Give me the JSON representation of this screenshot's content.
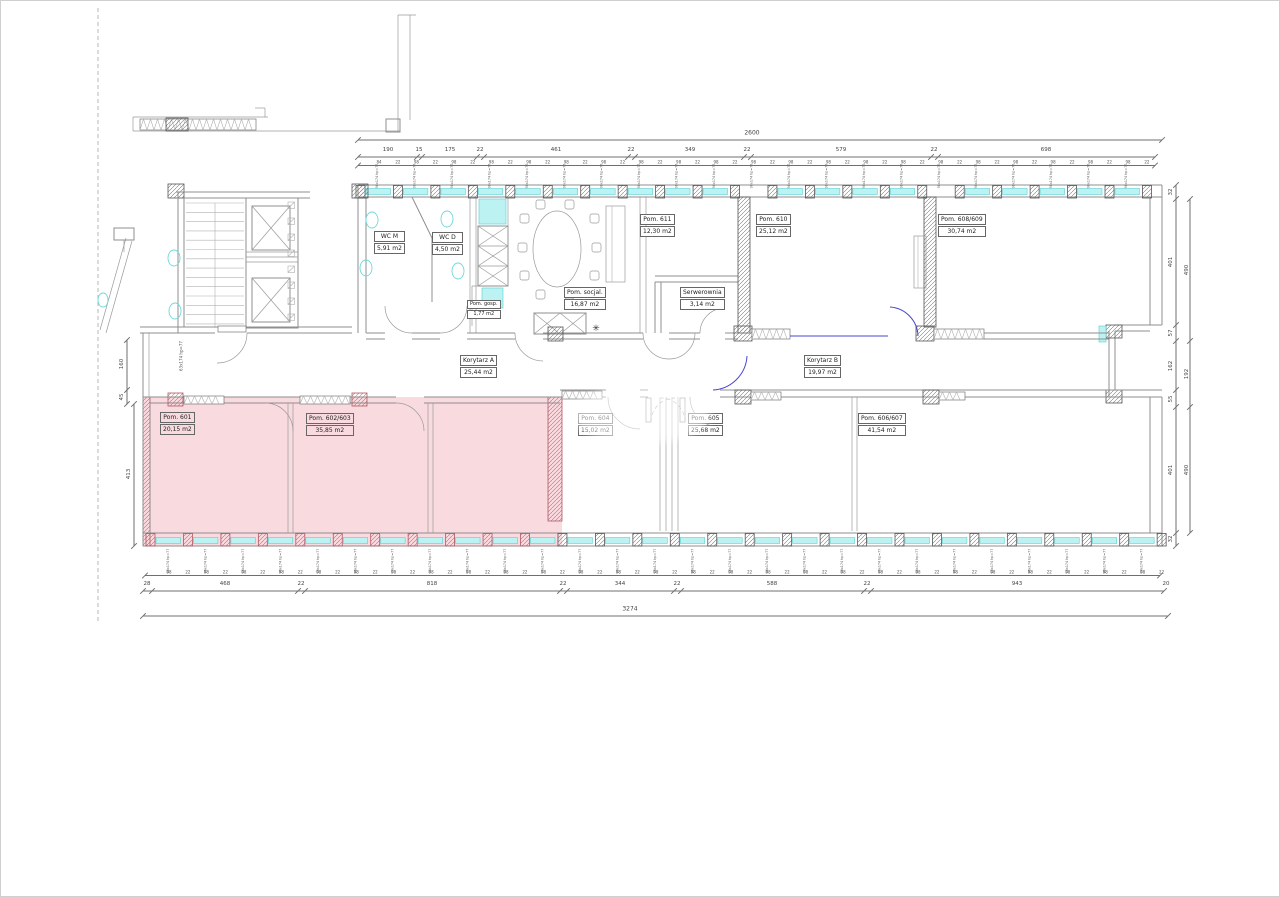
{
  "plan": {
    "rooms": {
      "wc_m": {
        "name": "WC M",
        "area": "5,91 m2"
      },
      "wc_d": {
        "name": "WC D",
        "area": "4,50 m2"
      },
      "pom_gosp": {
        "name": "Pom. gosp.",
        "area": "1,77 m2"
      },
      "pom_socjal": {
        "name": "Pom. socjal.",
        "area": "16,87 m2"
      },
      "pom_611": {
        "name": "Pom. 611",
        "area": "12,30 m2"
      },
      "serwerownia": {
        "name": "Serwerownia",
        "area": "3,14 m2"
      },
      "pom_610": {
        "name": "Pom. 610",
        "area": "25,12 m2"
      },
      "pom_608_609": {
        "name": "Pom. 608/609",
        "area": "30,74 m2"
      },
      "korytarz_a": {
        "name": "Korytarz A",
        "area": "25,44 m2"
      },
      "korytarz_b": {
        "name": "Korytarz B",
        "area": "19,97 m2"
      },
      "pom_601": {
        "name": "Pom. 601",
        "area": "20,15 m2"
      },
      "pom_602_603": {
        "name": "Pom. 602/603",
        "area": "35,85  m2"
      },
      "pom_604": {
        "name": "Pom. 604",
        "area": "15,02 m2"
      },
      "pom_605": {
        "name": "Pom. 605",
        "area": "25,68 m2"
      },
      "pom_606_607": {
        "name": "Pom. 606/607",
        "area": "41,54 m2"
      }
    },
    "dims": {
      "top_total": "2600",
      "top_row": [
        "190",
        "15",
        "175",
        "22",
        "461",
        "22",
        "349",
        "22",
        "579",
        "22",
        "698"
      ],
      "bottom_row": [
        "28",
        "468",
        "22",
        "818",
        "22",
        "344",
        "22",
        "588",
        "22",
        "943",
        "20"
      ],
      "bottom_total": "3274",
      "right_inner": [
        "32",
        "401",
        "57",
        "162",
        "55",
        "401",
        "32"
      ],
      "right_outer": [
        "490",
        "192",
        "490"
      ],
      "left": [
        "160",
        "45",
        "413"
      ],
      "fine_first_top": "84",
      "fine_pair": [
        "98",
        "22"
      ],
      "window_label": "98x174 hp=77",
      "stair_label": "63x174 hp=77"
    },
    "symbols": {
      "asterisk": "✳"
    },
    "colors": {
      "highlight_fill": "#f8dadf",
      "highlight_wall": "#b25862",
      "window_sill": "#bdf2f3",
      "new_wall_blue": "#4745d0",
      "linework": "#8f8f8f"
    }
  }
}
